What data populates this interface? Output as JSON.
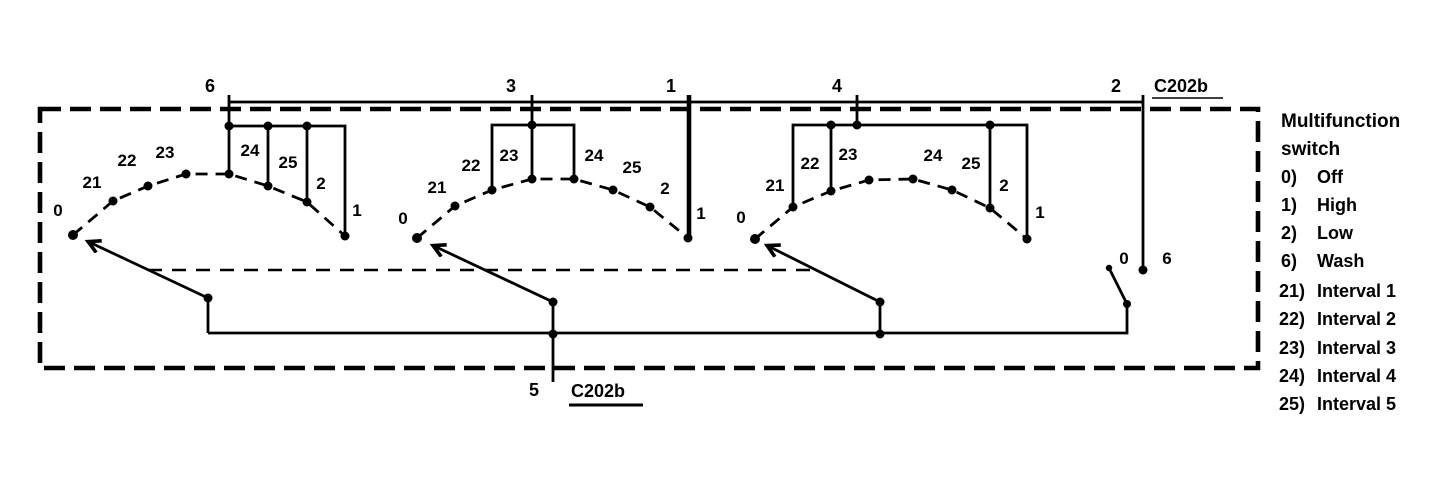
{
  "colors": {
    "ink": "#000000",
    "paper": "#ffffff"
  },
  "connector_top": {
    "label": "C202b",
    "pins": [
      "6",
      "3",
      "1",
      "4",
      "2"
    ]
  },
  "connector_bottom": {
    "pin": "5",
    "label": "C202b"
  },
  "wafers": [
    {
      "contacts": [
        "0",
        "21",
        "22",
        "23",
        "24",
        "25",
        "2",
        "1"
      ]
    },
    {
      "contacts": [
        "0",
        "21",
        "22",
        "23",
        "24",
        "25",
        "2",
        "1"
      ]
    },
    {
      "contacts": [
        "0",
        "21",
        "22",
        "23",
        "24",
        "25",
        "2",
        "1"
      ]
    }
  ],
  "wash_switch": {
    "positions": [
      "0",
      "6"
    ]
  },
  "legend": {
    "title_lines": [
      "Multifunction",
      "switch"
    ],
    "items": [
      {
        "code": "0)",
        "desc": "Off"
      },
      {
        "code": "1)",
        "desc": "High"
      },
      {
        "code": "2)",
        "desc": "Low"
      },
      {
        "code": "6)",
        "desc": "Wash"
      },
      {
        "code": "21)",
        "desc": "Interval 1"
      },
      {
        "code": "22)",
        "desc": "Interval 2"
      },
      {
        "code": "23)",
        "desc": "Interval 3"
      },
      {
        "code": "24)",
        "desc": "Interval 4"
      },
      {
        "code": "25)",
        "desc": "Interval 5"
      }
    ]
  }
}
